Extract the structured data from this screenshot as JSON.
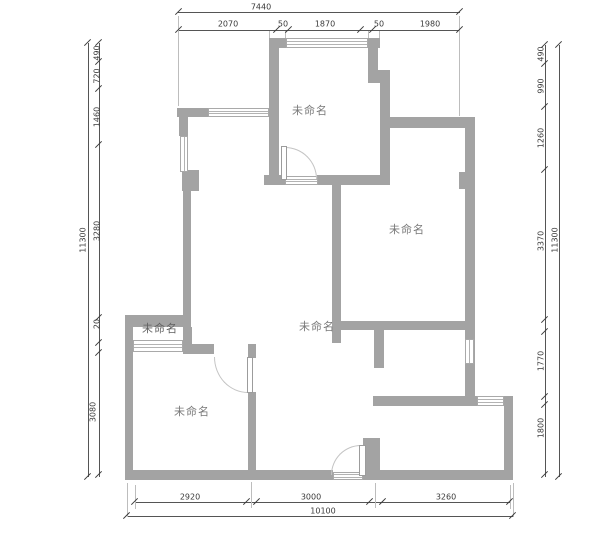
{
  "title": "未命名户型图",
  "colors": {
    "wall": "#a3a3a3",
    "dim_line": "#555555",
    "dim_text": "#3a3a3a",
    "room_label": "#787878"
  },
  "rooms": {
    "top": {
      "label": "未命名"
    },
    "right": {
      "label": "未命名"
    },
    "center": {
      "label": "未命名"
    },
    "left_small": {
      "label": "未命名"
    },
    "bottom_left": {
      "label": "未命名"
    }
  },
  "dimensions": {
    "top": {
      "total": "7440",
      "segments": [
        "2070",
        "50",
        "1870",
        "50",
        "1980"
      ]
    },
    "left": {
      "total": "11300",
      "segments": [
        "490",
        "720",
        "1460",
        "3280",
        "20",
        "3080"
      ]
    },
    "right": {
      "total": "11300",
      "segments": [
        "490",
        "990",
        "1260",
        "3370",
        "1770",
        "1800"
      ]
    },
    "bottom": {
      "total": "10100",
      "segments": [
        "2920",
        "3000",
        "3260"
      ]
    }
  }
}
